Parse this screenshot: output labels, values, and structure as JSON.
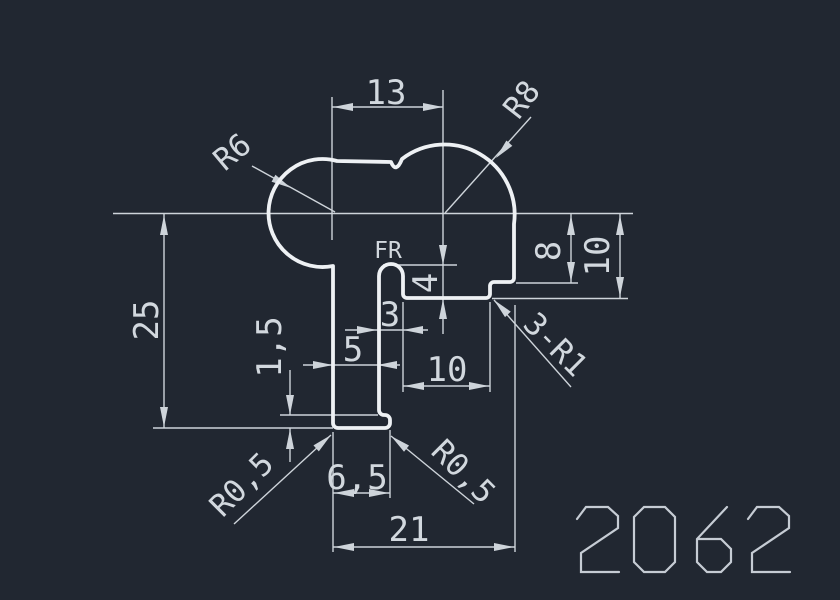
{
  "background_color": "#212731",
  "profile_line_color": "#eef1f4",
  "dimension_line_color": "#ced4da",
  "part_number": "2062",
  "labels": {
    "dim13": "13",
    "r8": "R8",
    "r6": "R6",
    "dim25": "25",
    "dim1_5": "1,5",
    "dim5": "5",
    "dim3": "3",
    "fr": "FR",
    "dim4": "4",
    "dim10_middle": "10",
    "dim8": "8",
    "dim10_right": "10",
    "three_r1": "3-R1",
    "r05_left": "R0,5",
    "r05_right": "R0,5",
    "dim6_5": "6,5",
    "dim21": "21"
  }
}
